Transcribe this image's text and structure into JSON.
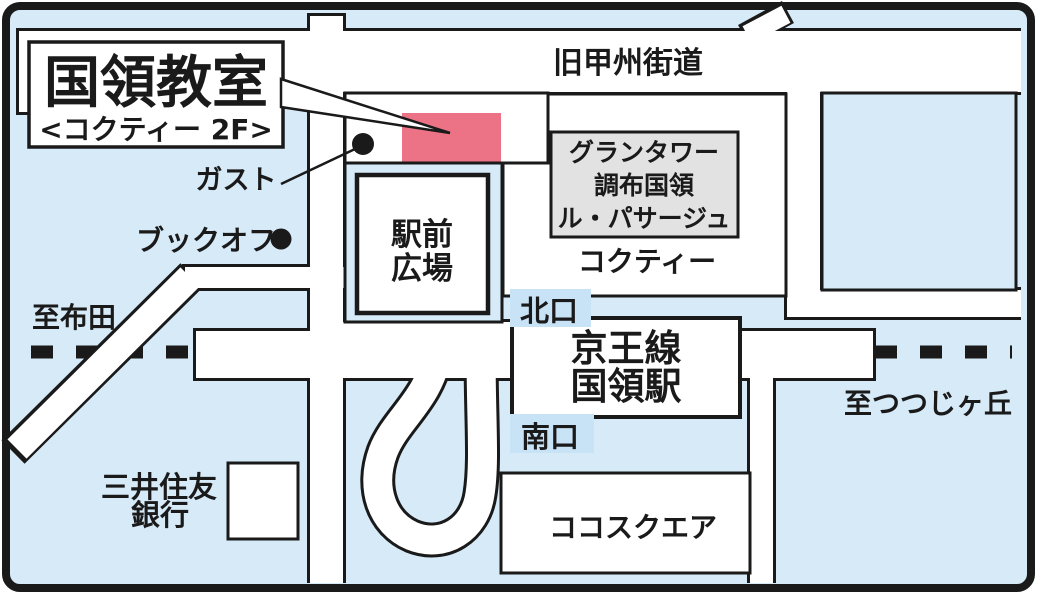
{
  "map": {
    "title": {
      "line1": "国領教室",
      "line2": "<コクティー 2F>"
    },
    "roads": {
      "old_koshu_kaido": "旧甲州街道"
    },
    "station": {
      "line_name": "京王線",
      "station_name": "国領駅",
      "north_exit": "北口",
      "south_exit": "南口"
    },
    "landmarks": {
      "gusto": "ガスト",
      "bookoff": "ブックオフ",
      "plaza_line1": "駅前",
      "plaza_line2": "広場",
      "grantower_line1": "グランタワー",
      "grantower_line2": "調布国領",
      "grantower_line3": "ル・パサージュ",
      "cocty": "コクティー",
      "coco_square": "ココスクエア",
      "bank_line1": "三井住友",
      "bank_line2": "銀行"
    },
    "directions": {
      "to_fuda": "至布田",
      "to_tsutsujigaoka": "至つつじヶ丘"
    },
    "colors": {
      "background": "#d6eaf8",
      "road_white": "#ffffff",
      "line_black": "#1a1a1a",
      "classroom_pink": "#ec7386",
      "title_blue": "#1566ae",
      "title_pink": "#e97287",
      "building_gray": "#e2e2e2",
      "exit_label_blue": "#c9e3f6"
    }
  }
}
